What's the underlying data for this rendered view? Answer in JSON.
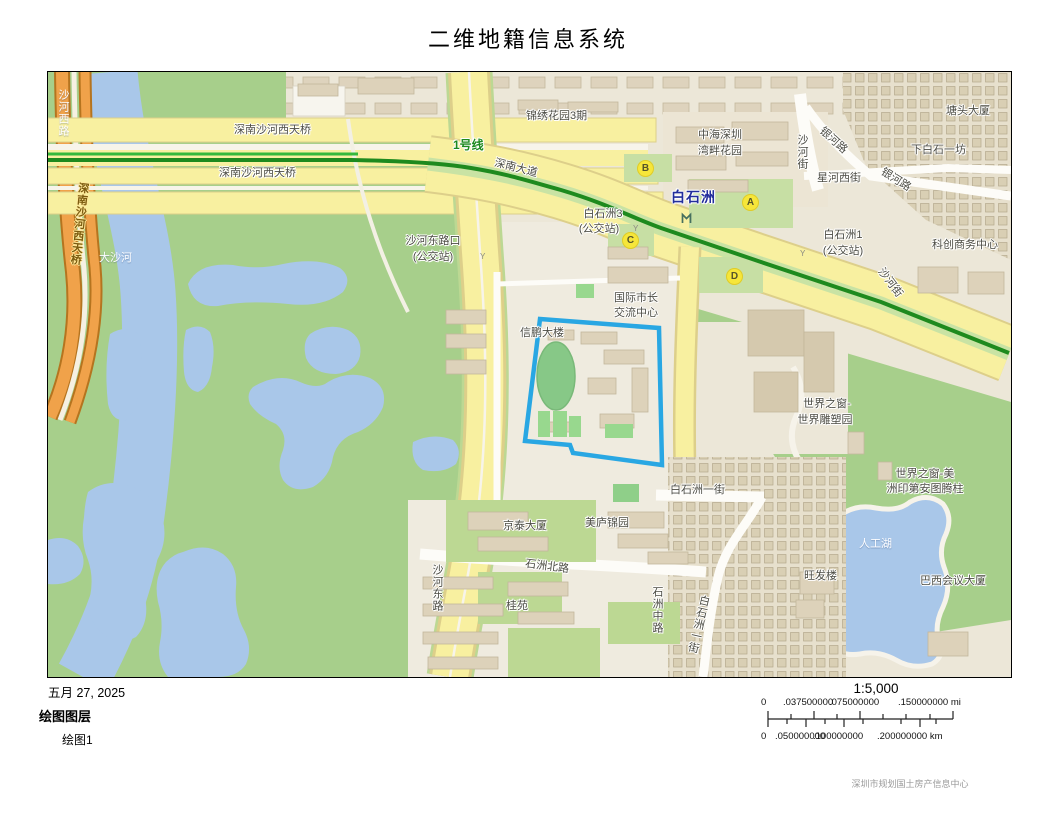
{
  "header": {
    "title": "二维地籍信息系统"
  },
  "map": {
    "station": {
      "name": "白石洲"
    },
    "exits": [
      {
        "letter": "A"
      },
      {
        "letter": "B"
      },
      {
        "letter": "C"
      },
      {
        "letter": "D"
      }
    ],
    "labels": {
      "shahe_west_road": "沙河西路",
      "bridge_vertical": "深南沙河西天桥",
      "bridge_upper": "深南沙河西天桥",
      "bridge_lower": "深南沙河西天桥",
      "metro_line_1": "1号线",
      "shennan_avenue": "深南大道",
      "jinxiu_garden": "锦绣花园3期",
      "zhonghai_line1": "中海深圳",
      "zhonghai_line2": "湾畔花园",
      "shahe_street_upper": "沙河街",
      "yinhe_road_upper": "银河路",
      "yinhe_road_lower": "银河路",
      "tangtou_building": "塘头大厦",
      "xiabaishi_yifang": "下白石一坊",
      "xinghe_west_street": "星河西街",
      "kechuang_center": "科创商务中心",
      "bsz3_stop_line1": "白石洲3",
      "bsz3_stop_line2": "(公交站)",
      "shahedong_stop_line1": "沙河东路口",
      "shahedong_stop_line2": "(公交站)",
      "bsz1_stop_line1": "白石洲1",
      "bsz1_stop_line2": "(公交站)",
      "shahe_street_diag": "沙河街",
      "intl_mayor_line1": "国际市长",
      "intl_mayor_line2": "交流中心",
      "xinpeng_building": "信鹏大楼",
      "dasha_river": "大沙河",
      "jingtai_building": "京泰大厦",
      "meilu_jinyuan": "美庐锦园",
      "shizhou_north_road": "石洲北路",
      "guiyuan": "桂苑",
      "shahe_east_road": "沙河东路",
      "shizhou_middle_road": "石洲中路",
      "bsz_first_street_h": "白石洲一街",
      "bsz_first_street_v": "白石洲一街",
      "wow_sculpture_line1": "世界之窗-",
      "wow_sculpture_line2": "世界雕塑园",
      "wow_totem_line1": "世界之窗-美",
      "wow_totem_line2": "洲印第安图腾柱",
      "artificial_lake": "人工湖",
      "wangfa_building": "旺发楼",
      "brazil_building": "巴西会议大厦"
    },
    "colors": {
      "park_green": "#a7cf8b",
      "water_blue": "#a9c7e9",
      "road_yellow": "#f8f0a0",
      "orange_road": "#f0a24a",
      "metro_green": "#1e8a1e",
      "parcel_outline": "#29a7e3",
      "exit_yellow": "#f6e63a",
      "station_text": "#232e9c"
    }
  },
  "footer": {
    "date": "五月 27, 2025",
    "legend_title": "绘图图层",
    "legend_item": "绘图1",
    "scale_ratio": "1:5,000",
    "scale_mi": [
      "0",
      ".037500000",
      ".075000000",
      ".150000000 mi"
    ],
    "scale_km": [
      "0",
      ".050000000",
      ".100000000",
      ".200000000 km"
    ]
  },
  "watermark": "深圳市规划国土房产信息中心"
}
